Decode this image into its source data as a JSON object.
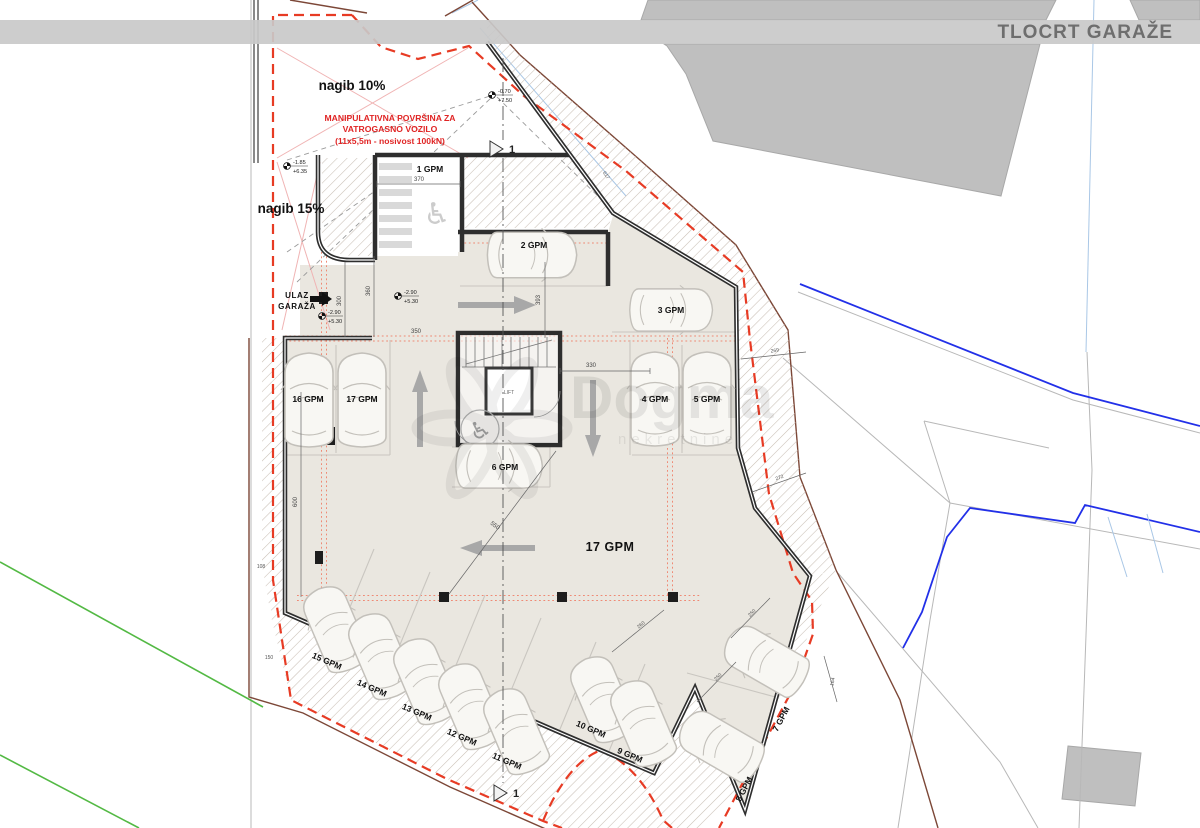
{
  "header": {
    "title": "TLOCRT GARAŽE"
  },
  "annotations": {
    "slope_upper": "nagib 10%",
    "slope_lower": "nagib 15%",
    "fire_area_line1": "MANIPULATIVNA POVRŠINA ZA",
    "fire_area_line2": "VATROGASNO VOZILO",
    "fire_area_line3": "(11x5,5m - nosivost 100kN)",
    "entrance_line1": "ULAZ",
    "entrance_line2": "GARAŽA",
    "zone_label": "17 GPM",
    "lift": "LIFT",
    "section_marker": "1"
  },
  "elevations": [
    {
      "upper": "-0.70",
      "lower": "+7.50"
    },
    {
      "upper": "-1.85",
      "lower": "+6.35"
    },
    {
      "upper": "-2.90",
      "lower": "+5.30"
    },
    {
      "upper": "-2.90",
      "lower": "+5.30"
    }
  ],
  "spots": [
    "1 GPM",
    "2 GPM",
    "3 GPM",
    "4 GPM",
    "5 GPM",
    "6 GPM",
    "7 GPM",
    "8 GPM",
    "9 GPM",
    "10 GPM",
    "11 GPM",
    "12 GPM",
    "13 GPM",
    "14 GPM",
    "15 GPM",
    "16 GPM",
    "17 GPM"
  ],
  "dims": [
    "370",
    "393",
    "617",
    "300",
    "360",
    "350",
    "330",
    "600",
    "108",
    "150",
    "550",
    "269",
    "272",
    "260",
    "250",
    "250",
    "164"
  ],
  "icons": {
    "wheelchair": "♿"
  },
  "watermark": {
    "name": "Dogma",
    "sub": "nekretnine"
  },
  "colors": {
    "boundary_red": "#e73b24",
    "guide_red": "#ef8a75",
    "wall": "#2e2e2e",
    "interior": "#eae7e0",
    "utility_blue": "#2230e8",
    "terrain_green": "#53b944",
    "retaining_brown": "#7c4737",
    "band_gray": "#c9c9c9"
  }
}
